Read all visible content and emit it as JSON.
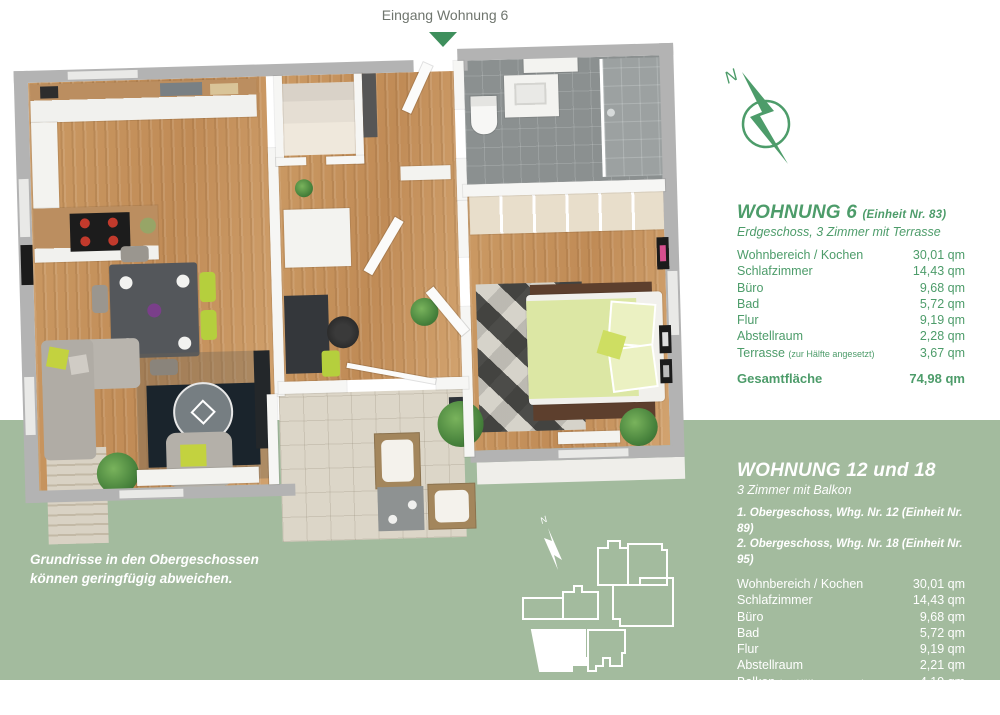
{
  "entrance": {
    "label": "Eingang Wohnung 6"
  },
  "compass": {
    "label": "N"
  },
  "sitemap": {
    "compass_label": "N"
  },
  "disclaimer": {
    "line1": "Grundrisse in den Obergeschossen",
    "line2": "können geringfügig abweichen."
  },
  "unit_top": {
    "title": "WOHNUNG 6",
    "title_note": "(Einheit Nr. 83)",
    "subtitle": "Erdgeschoss, 3 Zimmer mit Terrasse",
    "rows": [
      {
        "label": "Wohnbereich / Kochen",
        "note": "",
        "value": "30,01 qm"
      },
      {
        "label": "Schlafzimmer",
        "note": "",
        "value": "14,43 qm"
      },
      {
        "label": "Büro",
        "note": "",
        "value": "9,68 qm"
      },
      {
        "label": "Bad",
        "note": "",
        "value": "5,72 qm"
      },
      {
        "label": "Flur",
        "note": "",
        "value": "9,19 qm"
      },
      {
        "label": "Abstellraum",
        "note": "",
        "value": "2,28 qm"
      },
      {
        "label": "Terrasse ",
        "note": "(zur Hälfte angesetzt)",
        "value": "3,67 qm"
      }
    ],
    "total": {
      "label": "Gesamtfläche",
      "value": "74,98 qm"
    }
  },
  "unit_bottom": {
    "title": "WOHNUNG 12 und 18",
    "subtitle": "3 Zimmer mit Balkon",
    "floor_lines": [
      "1. Obergeschoss, Whg. Nr. 12 (Einheit Nr. 89)",
      "2. Obergeschoss, Whg. Nr. 18 (Einheit Nr. 95)"
    ],
    "rows": [
      {
        "label": "Wohnbereich / Kochen",
        "note": "",
        "value": "30,01 qm"
      },
      {
        "label": "Schlafzimmer",
        "note": "",
        "value": "14,43 qm"
      },
      {
        "label": "Büro",
        "note": "",
        "value": "9,68 qm"
      },
      {
        "label": "Bad",
        "note": "",
        "value": "5,72 qm"
      },
      {
        "label": "Flur",
        "note": "",
        "value": "9,19 qm"
      },
      {
        "label": "Abstellraum",
        "note": "",
        "value": "2,21 qm"
      },
      {
        "label": "Balkon ",
        "note": "(zur Hälfte angesetzt)",
        "value": "4,19 qm"
      }
    ],
    "total": {
      "label": "Gesamtfläche",
      "value": "75,43 qm"
    }
  },
  "colors": {
    "accent_green": "#4d9c6a",
    "sage_background": "#a3bb9e",
    "arrow_green": "#3e8f5c"
  }
}
